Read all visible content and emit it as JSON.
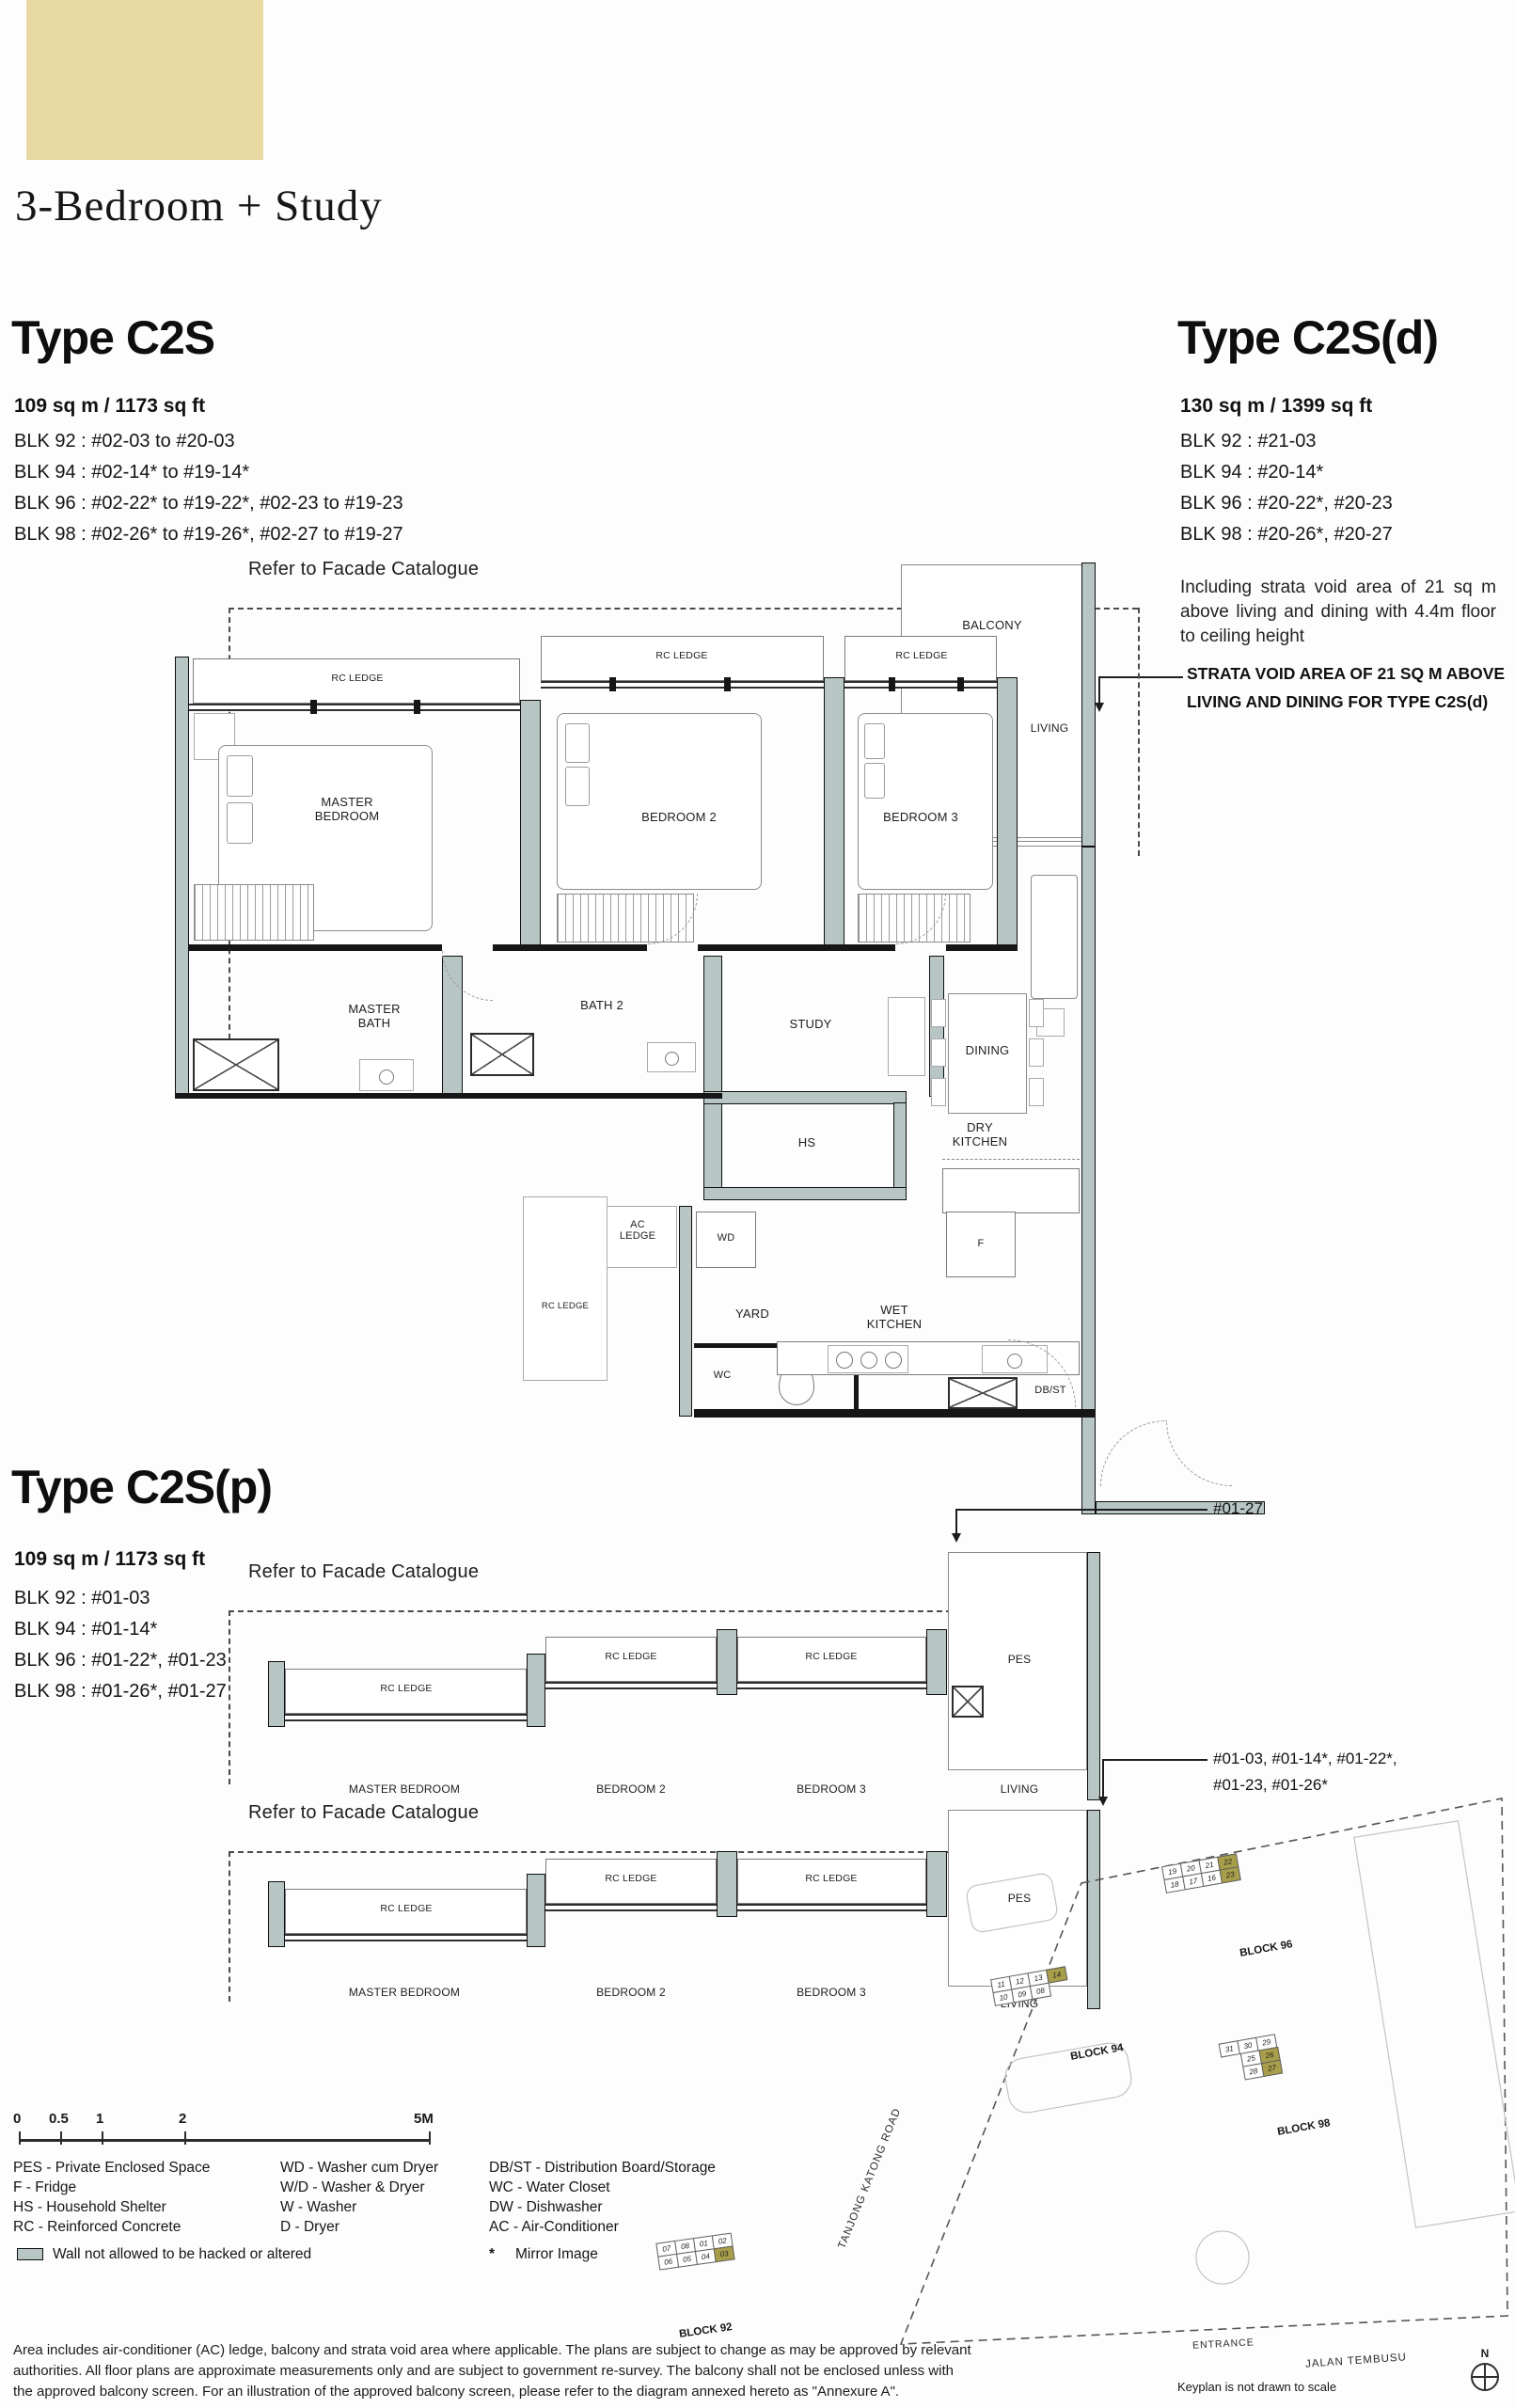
{
  "header": {
    "title": "3-Bedroom + Study"
  },
  "types": {
    "c2s": {
      "name": "Type C2S",
      "area": "109 sq m / 1173 sq ft",
      "blocks": [
        "BLK 92 : #02-03 to #20-03",
        "BLK 94 : #02-14* to #19-14*",
        "BLK 96 : #02-22* to #19-22*, #02-23 to #19-23",
        "BLK 98 : #02-26* to #19-26*, #02-27 to #19-27"
      ]
    },
    "c2sd": {
      "name": "Type C2S(d)",
      "area": "130 sq m / 1399 sq ft",
      "blocks": [
        "BLK 92 : #21-03",
        "BLK 94 : #20-14*",
        "BLK 96 : #20-22*, #20-23",
        "BLK 98 : #20-26*, #20-27"
      ],
      "note": "Including strata void area of 21 sq m above living and dining with 4.4m floor to ceiling height",
      "callout_line1": "STRATA VOID AREA OF 21 SQ M ABOVE",
      "callout_line2": "LIVING AND DINING FOR TYPE  C2S(d)"
    },
    "c2sp": {
      "name": "Type C2S(p)",
      "area": "109 sq m / 1173 sq ft",
      "blocks": [
        "BLK 92 : #01-03",
        "BLK 94 : #01-14*",
        "BLK 96 : #01-22*, #01-23",
        "BLK 98 : #01-26*, #01-27"
      ],
      "callout_top": "#01-27",
      "callout_bottom_line1": "#01-03, #01-14*, #01-22*,",
      "callout_bottom_line2": "#01-23, #01-26*"
    }
  },
  "plan_labels": {
    "facade": "Refer to Facade Catalogue",
    "rc_ledge": "RC LEDGE",
    "master_l1": "MASTER",
    "master_l2": "BEDROOM",
    "master_full": "MASTER BEDROOM",
    "bedroom2": "BEDROOM 2",
    "bedroom3": "BEDROOM 3",
    "balcony": "BALCONY",
    "living": "LIVING",
    "mbath_l1": "MASTER",
    "mbath_l2": "BATH",
    "bath2": "BATH 2",
    "study": "STUDY",
    "dining": "DINING",
    "dry_l1": "DRY",
    "dry_l2": "KITCHEN",
    "hs": "HS",
    "ac_l1": "AC",
    "ac_l2": "LEDGE",
    "wd": "WD",
    "yard": "YARD",
    "wet_l1": "WET",
    "wet_l2": "KITCHEN",
    "wc": "WC",
    "f": "F",
    "dbst": "DB/ST",
    "pes": "PES"
  },
  "scalebar": {
    "labels": [
      "0",
      "0.5",
      "1",
      "2",
      "5M"
    ]
  },
  "legend": {
    "col1": [
      "PES - Private Enclosed Space",
      "F - Fridge",
      "HS - Household Shelter",
      "RC - Reinforced Concrete"
    ],
    "col2": [
      "WD - Washer cum Dryer",
      "W/D - Washer & Dryer",
      "W - Washer",
      "D - Dryer"
    ],
    "col3": [
      "DB/ST - Distribution Board/Storage",
      "WC - Water Closet",
      "DW - Dishwasher",
      "AC - Air-Conditioner"
    ],
    "wall_note": "Wall not allowed to be hacked or altered",
    "mirror_star": "*",
    "mirror_note": "Mirror Image"
  },
  "notes": {
    "line1": "Area includes air-conditioner (AC) ledge, balcony and strata void area where applicable. The plans are subject to change as may be approved by relevant",
    "line2": "authorities. All floor plans are approximate measurements only and are subject to government re-survey. The balcony shall not be enclosed unless with",
    "line3": "the approved balcony screen. For an illustration of the approved balcony screen, please refer to the diagram annexed hereto as \"Annexure A\"."
  },
  "keyplan": {
    "not_to_scale": "Keyplan is not drawn to scale",
    "compass_n": "N",
    "roads": {
      "tanjong": "TANJONG KATONG ROAD",
      "entrance": "ENTRANCE",
      "jalan": "JALAN TEMBUSU"
    },
    "blocks": [
      {
        "name": "BLOCK 96",
        "units": [
          "19",
          "20",
          "21",
          "22",
          "18",
          "17",
          "16",
          "23"
        ],
        "highlighted": [
          "22",
          "23"
        ]
      },
      {
        "name": "BLOCK 94",
        "units": [
          "11",
          "12",
          "13",
          "14",
          "10",
          "09",
          "08"
        ],
        "highlighted": [
          "14"
        ]
      },
      {
        "name": "BLOCK 98",
        "units": [
          "31",
          "30",
          "29",
          "25",
          "26",
          "28",
          "27"
        ],
        "highlighted": [
          "26",
          "27"
        ]
      },
      {
        "name": "BLOCK 92",
        "units": [
          "07",
          "08",
          "01",
          "02",
          "06",
          "05",
          "04",
          "03"
        ],
        "highlighted": [
          "03"
        ]
      }
    ]
  }
}
